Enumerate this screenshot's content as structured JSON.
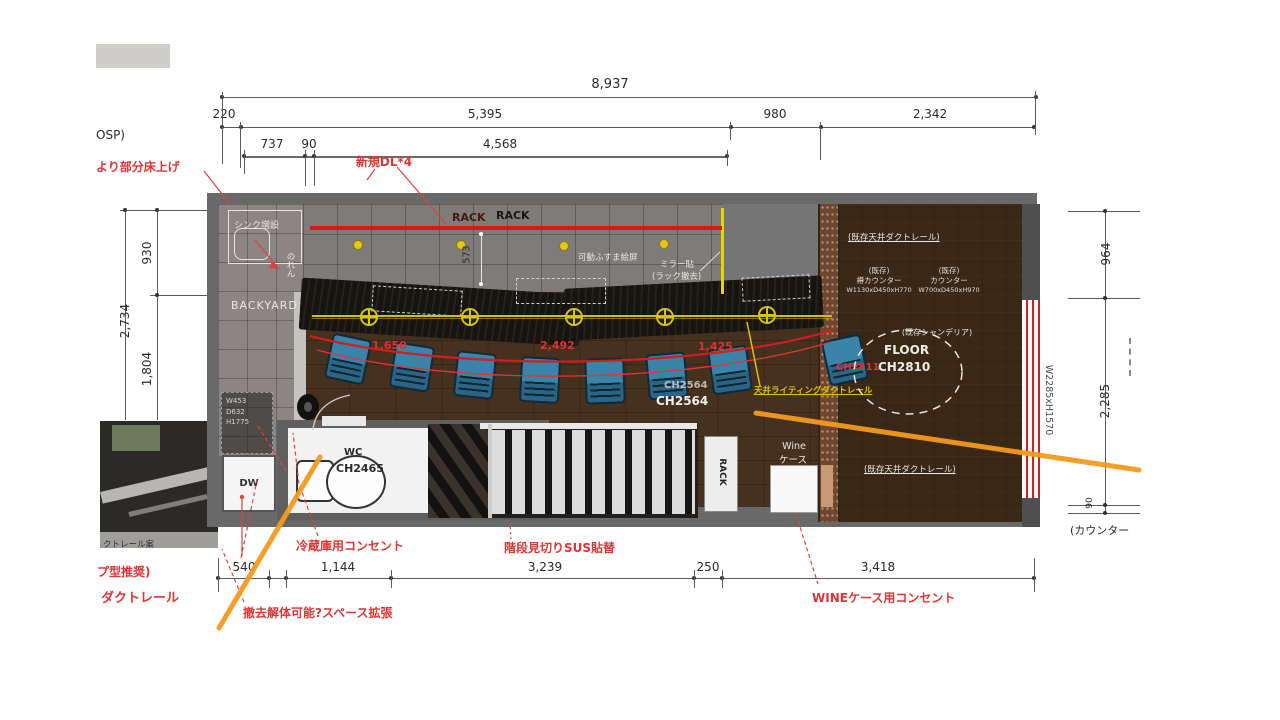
{
  "colors": {
    "accent_red": "#e03535",
    "accent_orange": "#f59a1d",
    "accent_yellow": "#d9c500",
    "chair_blue": "#2e7596",
    "wall_red_stripe": "#c22525"
  },
  "top_dims": {
    "overall": "8,937",
    "seg1": "220",
    "seg2": "5,395",
    "seg3": "980",
    "seg4": "2,342",
    "sub1": "737",
    "sub2": "90",
    "sub3": "4,568"
  },
  "left_dims": {
    "outer": "2,734",
    "upper": "930",
    "lower": "1,804"
  },
  "right_dims": {
    "upper": "964",
    "lower": "2,285",
    "small": "90",
    "counter_note": "(カウンター",
    "window": "W2285xH1570"
  },
  "bottom_dims": {
    "d1": "540",
    "d2": "1,144",
    "d3": "3,239",
    "d4": "250",
    "d5": "3,418"
  },
  "notes": {
    "osp": "OSP)",
    "floor_raise": "より部分床上げ",
    "new_dl": "新規DL*4",
    "fridge_outlet": "冷蔵庫用コンセント",
    "stair_sus": "階段見切りSUS貼替",
    "wine_outlet": "WINEケース用コンセント",
    "demolish": "撤去解体可能?スペース拡張",
    "duct_reco": "プ型推奨)",
    "duct_rail": "ダクトレール",
    "photo_caption": "クトレール案",
    "ch_red": "CH2811",
    "span1": "1,650",
    "span2": "2,492",
    "span3": "1,425"
  },
  "plan": {
    "backyard": "BACKYARD",
    "sink_add": "シンク増設",
    "noren": "のれん",
    "rack_a": "RACK",
    "rack_b": "RACK",
    "rack_depth": "573",
    "fusuma": "可動ふすま絵屏",
    "mirror_line1": "ミラー貼",
    "mirror_line2": "(ラック撤去)",
    "shelf_w": "W453",
    "shelf_d": "D632",
    "shelf_h": "H1775",
    "dw": "DW",
    "wc": "WC",
    "wc_ch": "CH2465",
    "rack_vert": "RACK",
    "wine_line1": "Wine",
    "wine_line2": "ケース",
    "ch2564_a": "CH2564",
    "ch2564_b": "CH2564",
    "duct_top": "(既存天井ダクトレール)",
    "duct_bottom": "(既存天井ダクトレール)",
    "exist_a": "(既存)",
    "taru_counter": "樽カウンター",
    "taru_size": "W1130xD450xH770",
    "exist_b": "(既存)",
    "counter": "カウンター",
    "counter_size": "W700xD450xH970",
    "chandelier": "(既存シャンデリア)",
    "floor_label": "FLOOR",
    "floor_ch": "CH2810",
    "lighting_duct": "天井ライティングダクトレール"
  }
}
